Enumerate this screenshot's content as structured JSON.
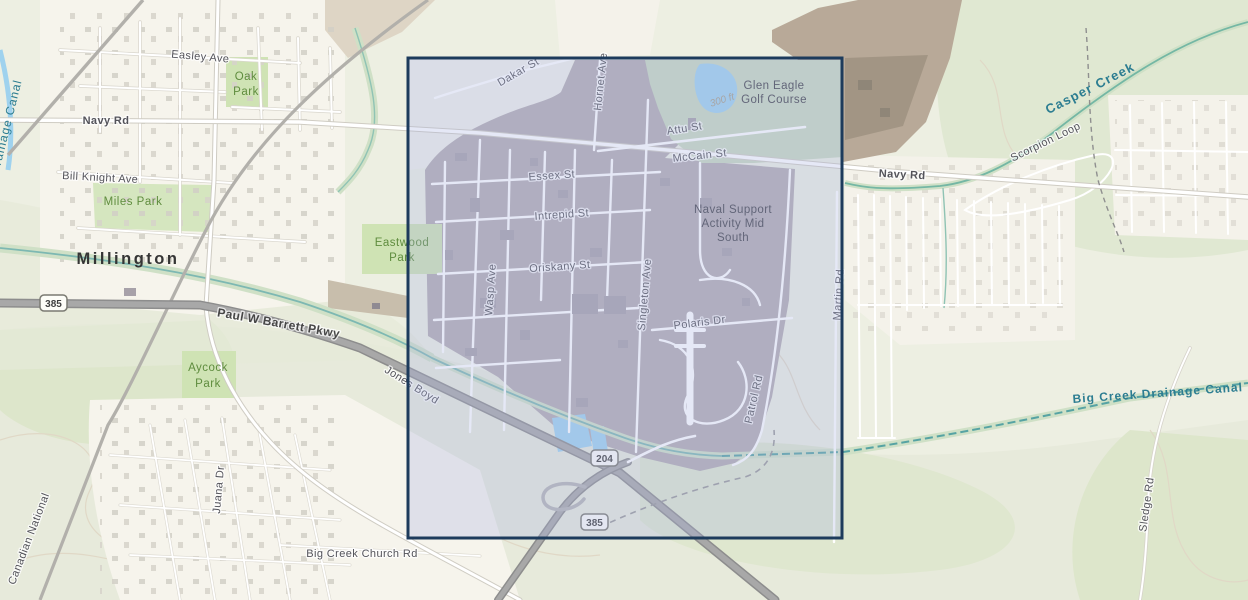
{
  "map": {
    "city_label": "Millington",
    "place_labels": {
      "naval_support": {
        "line1": "Naval Support",
        "line2": "Activity Mid",
        "line3": "South"
      },
      "glen_eagle": {
        "line1": "Glen Eagle",
        "line2": "Golf Course"
      },
      "oak_park": {
        "line1": "Oak",
        "line2": "Park"
      },
      "eastwood_park": {
        "line1": "Eastwood",
        "line2": "Park"
      },
      "aycock_park": {
        "line1": "Aycock",
        "line2": "Park"
      },
      "miles_park": "Miles Park"
    },
    "street_labels": {
      "easley": "Easley Ave",
      "navy_rd": "Navy Rd",
      "bill_knight": "Bill Knight Ave",
      "dakar": "Dakar St",
      "hornet": "Hornet Ave",
      "attu": "Attu St",
      "mccain": "McCain St",
      "essex": "Essex St",
      "intrepid": "Intrepid St",
      "oriskany": "Oriskany St",
      "wasp": "Wasp Ave",
      "singleton": "Singleton Ave",
      "polaris": "Polaris Dr",
      "patrol": "Patrol Rd",
      "martin": "Martin Rd",
      "scorpion": "Scorpion Loop",
      "paul_barrett": "Paul W Barrett Pkwy",
      "jones_boyd": "Jones Boyd",
      "juana": "Juana Dr",
      "canadian_national": "Canadian National",
      "big_creek_church": "Big Creek Church Rd",
      "sledge": "Sledge Rd"
    },
    "water_labels": {
      "drainage_canal": "Drainage Canal",
      "casper_creek": "Casper Creek",
      "big_creek_canal": "Big Creek Drainage Canal"
    },
    "route_shields": {
      "route_385": "385",
      "route_204": "204"
    },
    "annotations": {
      "contour_300": "300 ft"
    },
    "colors": {
      "selection_border": "#1d3b5c",
      "selection_fill": "rgba(168,180,226,0.30)",
      "base_area": "#b3adb2",
      "water": "#9fd2ee",
      "stream": "#6fb3ae",
      "park_green": "#cfe3b4",
      "highway_gray": "#a6a6a6"
    }
  }
}
